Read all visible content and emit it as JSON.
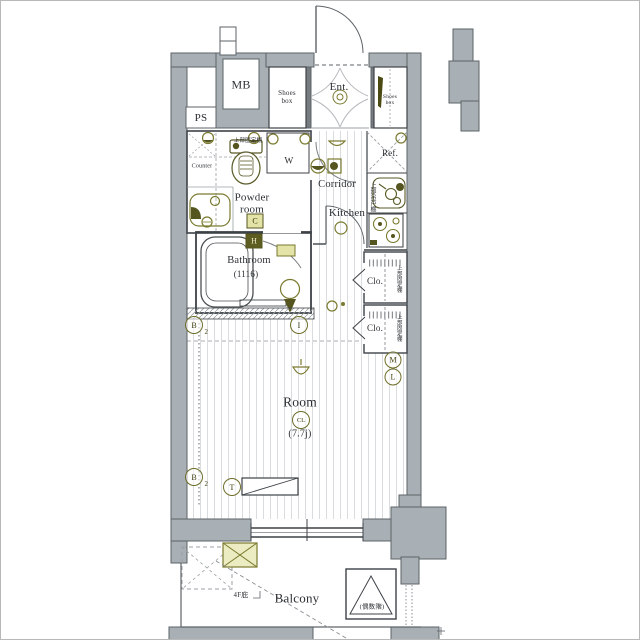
{
  "plan": {
    "rooms": {
      "mb": "MB",
      "ps": "PS",
      "shoes_box_left": "Shoes\nbox",
      "entrance": "Ent.",
      "shoes_box_right": "Shoes\nbox",
      "counter": "Counter",
      "upper_fixed_shelf": "上部固定棚",
      "washer": "W",
      "powder_room": "Powder\nroom",
      "corridor": "Corridor",
      "kitchen": "Kitchen",
      "refrigerator": "Ref.",
      "upper_hanging_cupboard": "上部吊戸棚",
      "bathroom": "Bathroom",
      "bathroom_size": "(1116)",
      "closet_upper": "Clo.",
      "closet_upper_shelf": "上部固定棚",
      "closet_lower": "Clo.",
      "closet_lower_shelf": "上部固定棚",
      "room": "Room",
      "ceiling_light": "CL",
      "room_size": "(7.7j)",
      "balcony": "Balcony",
      "eaves_note": "4F庇",
      "evacuation_hatch_note": "(偶数階)"
    },
    "markers": {
      "c": "C",
      "h": "H",
      "m": "M",
      "l": "L",
      "b_upper": "B",
      "b_upper_sub": "2",
      "b_lower": "B",
      "b_lower_sub": "2",
      "intercom": "I",
      "tv": "T"
    },
    "colors": {
      "wall": "#a9b0b5",
      "wall_edge": "#5d6368",
      "line": "#3d4247",
      "fixture": "#7a7a30",
      "fixture_dark": "#55551f",
      "highlight": "#e3e3a8",
      "floor_line": "#dadddf"
    }
  }
}
